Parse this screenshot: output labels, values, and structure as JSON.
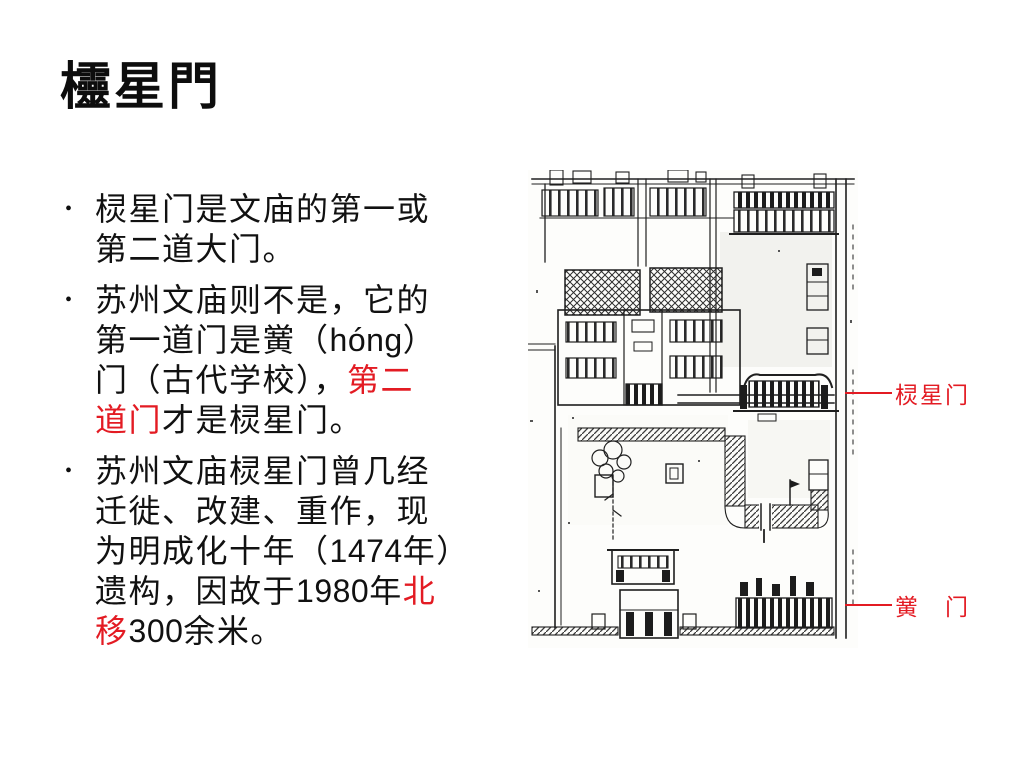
{
  "colors": {
    "red": "#e31b23",
    "ink": "#1f1f1f",
    "background": "#ffffff"
  },
  "title": "欞星門",
  "bullets": [
    {
      "marker": "•",
      "lines": [
        [
          {
            "t": "棂星门是文庙的第一或"
          }
        ],
        [
          {
            "t": "第二道大门。"
          }
        ]
      ]
    },
    {
      "marker": "•",
      "lines": [
        [
          {
            "t": "苏州文庙则不是，它的"
          }
        ],
        [
          {
            "t": "第一道门是黉（"
          },
          {
            "t": "hóng",
            "s": "latin"
          },
          {
            "t": "）"
          }
        ],
        [
          {
            "t": "门（古代学校），"
          },
          {
            "t": "第二",
            "s": "red"
          }
        ],
        [
          {
            "t": "道门",
            "s": "red"
          },
          {
            "t": "才是棂星门。"
          }
        ]
      ]
    },
    {
      "marker": "•",
      "lines": [
        [
          {
            "t": "苏州文庙棂星门曾几经"
          }
        ],
        [
          {
            "t": "迁徙、改建、重作，现"
          }
        ],
        [
          {
            "t": "为明成化十年（"
          },
          {
            "t": "1474",
            "s": "latin"
          },
          {
            "t": "年）"
          }
        ],
        [
          {
            "t": "遗构，因故于"
          },
          {
            "t": "1980",
            "s": "latin"
          },
          {
            "t": "年"
          },
          {
            "t": "北",
            "s": "red"
          }
        ],
        [
          {
            "t": "移",
            "s": "red"
          },
          {
            "t": "300",
            "s": "latin"
          },
          {
            "t": "余米。"
          }
        ]
      ]
    },
    {
      "marker": ""
    }
  ],
  "figure": {
    "description": "苏州文庙平面图",
    "labels": [
      {
        "text": "棂星门"
      },
      {
        "text": "黉　门"
      }
    ]
  }
}
